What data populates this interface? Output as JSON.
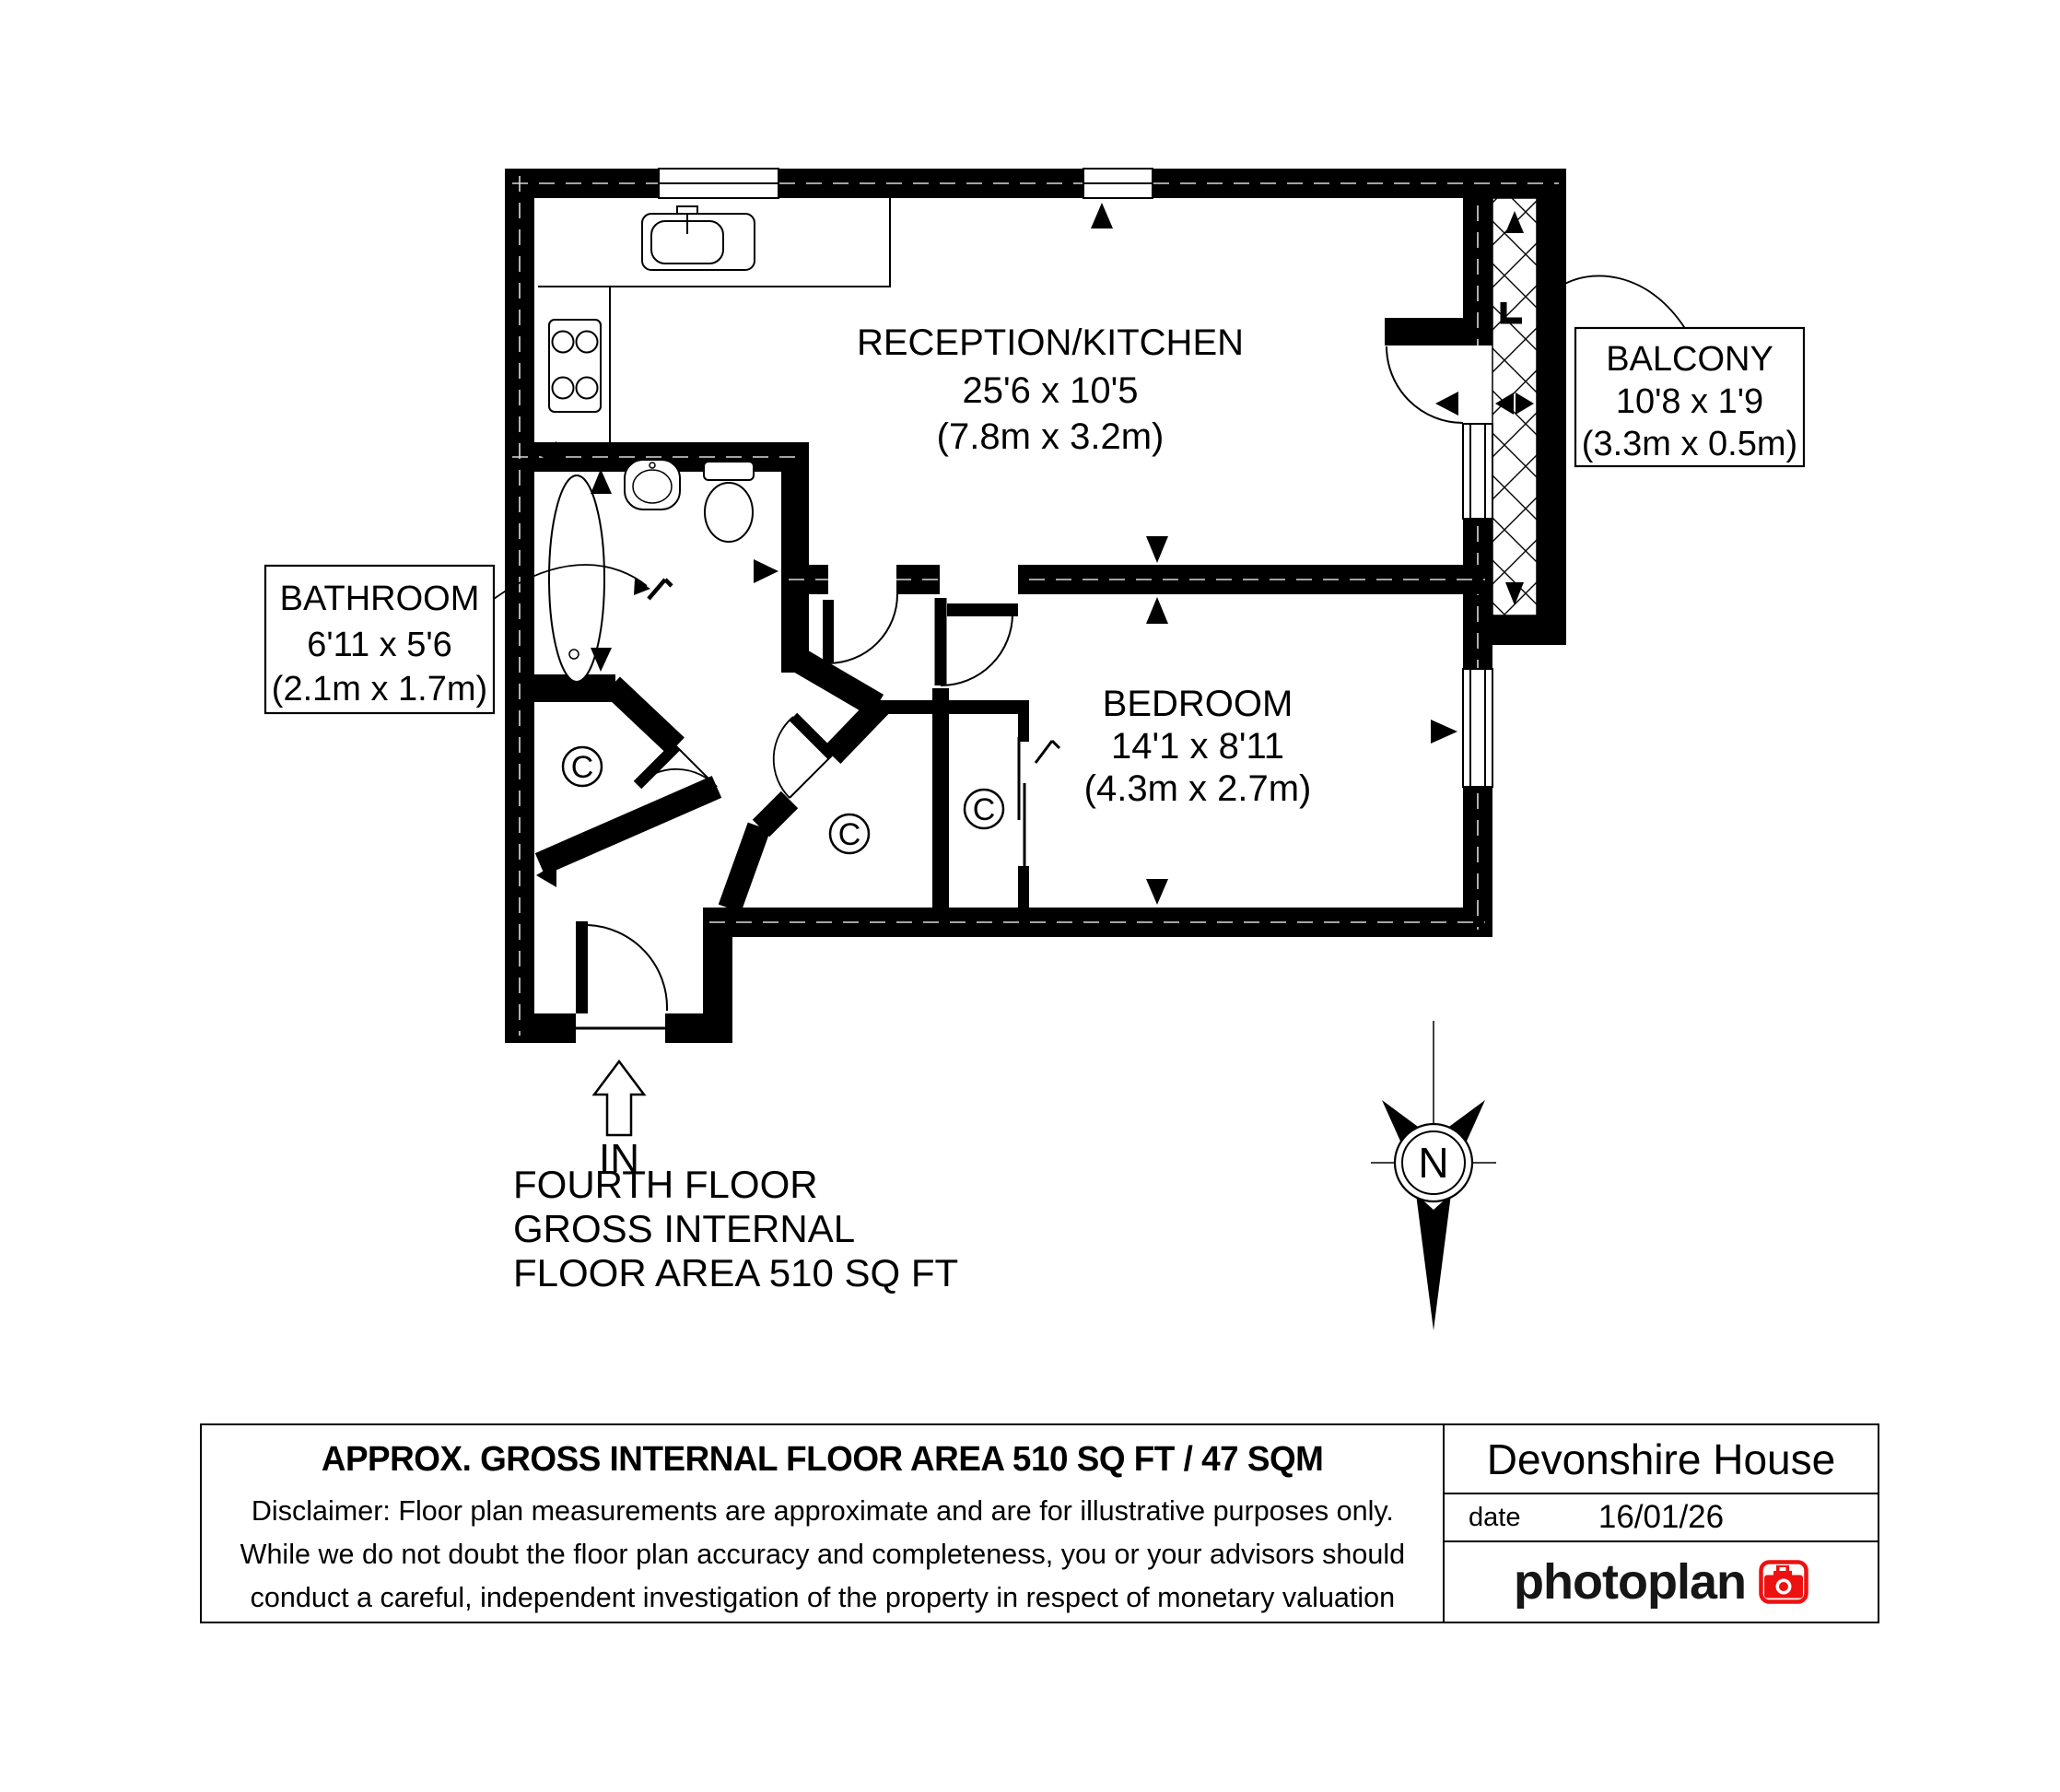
{
  "document": {
    "type": "floor-plan"
  },
  "plan": {
    "rooms": [
      {
        "id": "reception",
        "name": "RECEPTION/KITCHEN",
        "size_imperial": "25'6 x 10'5",
        "size_metric": "(7.8m x 3.2m)"
      },
      {
        "id": "bedroom",
        "name": "BEDROOM",
        "size_imperial": "14'1 x 8'11",
        "size_metric": "(4.3m x 2.7m)"
      },
      {
        "id": "bathroom",
        "name": "BATHROOM",
        "size_imperial": "6'11 x 5'6",
        "size_metric": "(2.1m x 1.7m)"
      },
      {
        "id": "balcony",
        "name": "BALCONY",
        "size_imperial": "10'8 x 1'9",
        "size_metric": "(3.3m x 0.5m)"
      }
    ],
    "closet_label": "C",
    "level_marker": "L",
    "entrance_label": "IN",
    "compass_label": "N",
    "floor_note_lines": [
      "FOURTH FLOOR",
      "GROSS INTERNAL",
      "FLOOR AREA 510 SQ FT"
    ]
  },
  "footer": {
    "area_statement": "APPROX. GROSS INTERNAL FLOOR AREA 510 SQ FT / 47 SQM",
    "disclaimer_lines": [
      "Disclaimer: Floor plan measurements are approximate and are for illustrative purposes only.",
      "While we do not doubt the floor plan accuracy and completeness, you or your advisors should",
      "conduct a careful, independent investigation of the property in respect of monetary valuation"
    ],
    "property_name": "Devonshire House",
    "date_label": "date",
    "date_value": "16/01/26",
    "brand_name": "photoplan",
    "colors": {
      "brand_red": "#ee1111",
      "ink": "#000000"
    }
  }
}
